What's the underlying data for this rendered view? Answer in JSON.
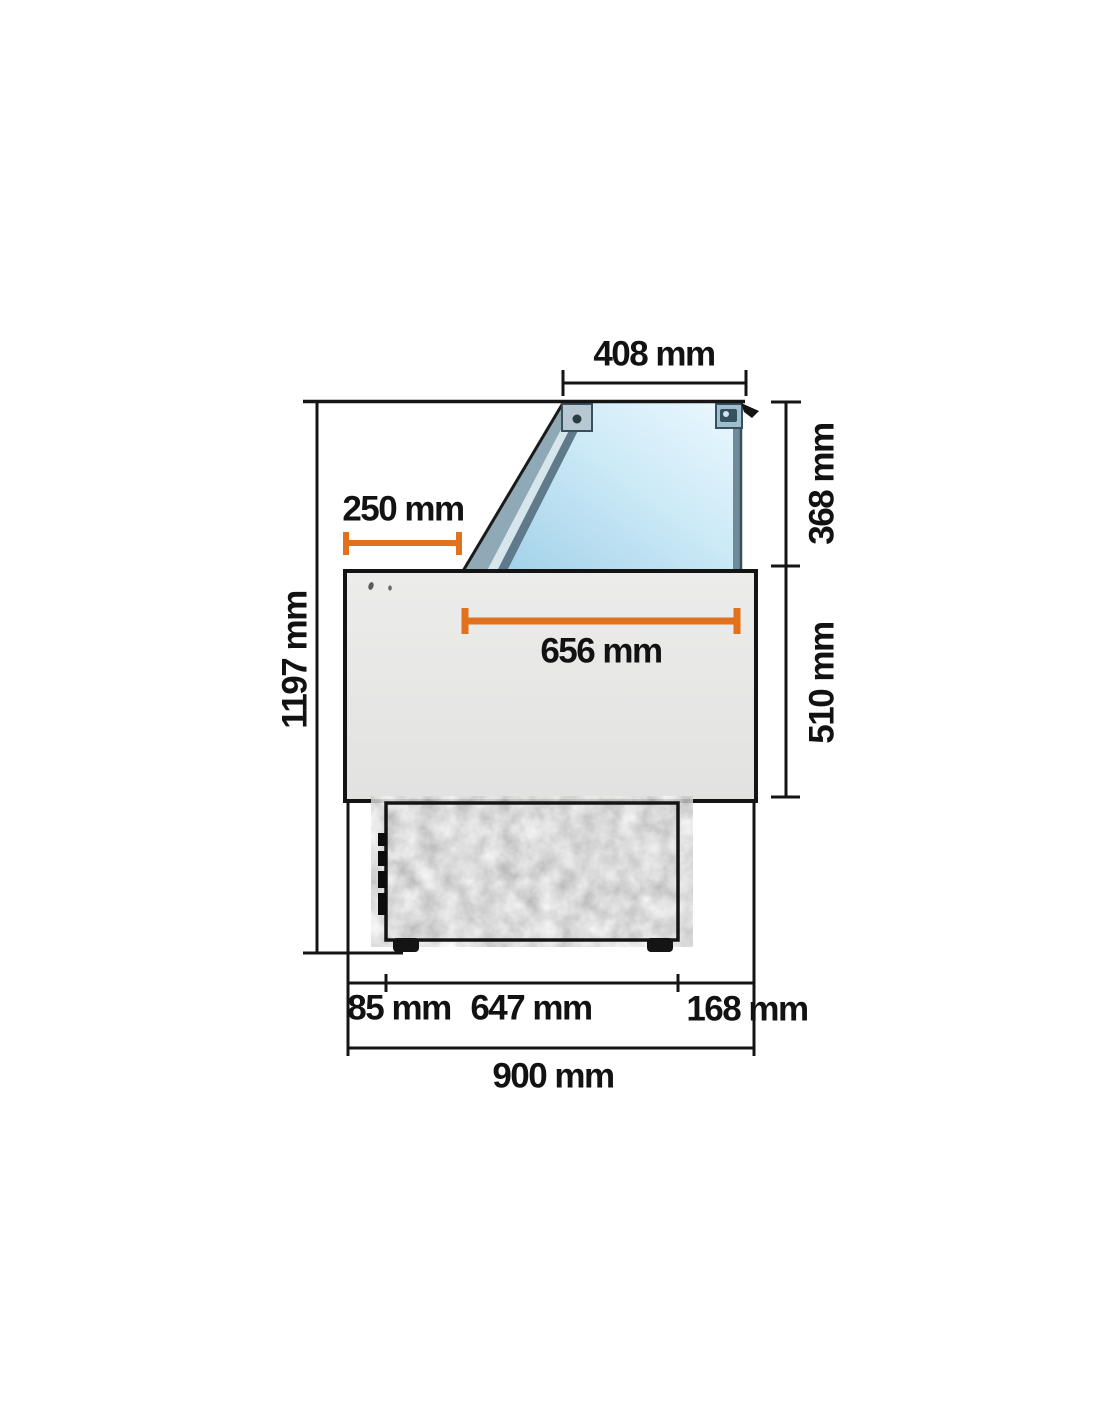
{
  "figure": {
    "type": "technical-dimension-drawing",
    "subject": "refrigerated-display-case-side-view",
    "units": "mm"
  },
  "labels": {
    "top_glass_width": "408 mm",
    "glass_overhang": "250 mm",
    "display_well_width": "656 mm",
    "glass_section_height": "368 mm",
    "body_section_height": "510 mm",
    "overall_height": "1197 mm",
    "base_front_offset": "85 mm",
    "base_depth": "647 mm",
    "base_rear_offset": "168 mm",
    "overall_depth": "900 mm"
  },
  "colors": {
    "dimension_orange": "#e2711d",
    "dimension_black": "#141414",
    "cabinet_gray": "#e7e7e6",
    "base_texture_gray": "#b9b9b9",
    "glass_blue_light": "#eaf8fe",
    "glass_blue": "#a3d2e9",
    "frame_steel": "#5f7b8b"
  }
}
